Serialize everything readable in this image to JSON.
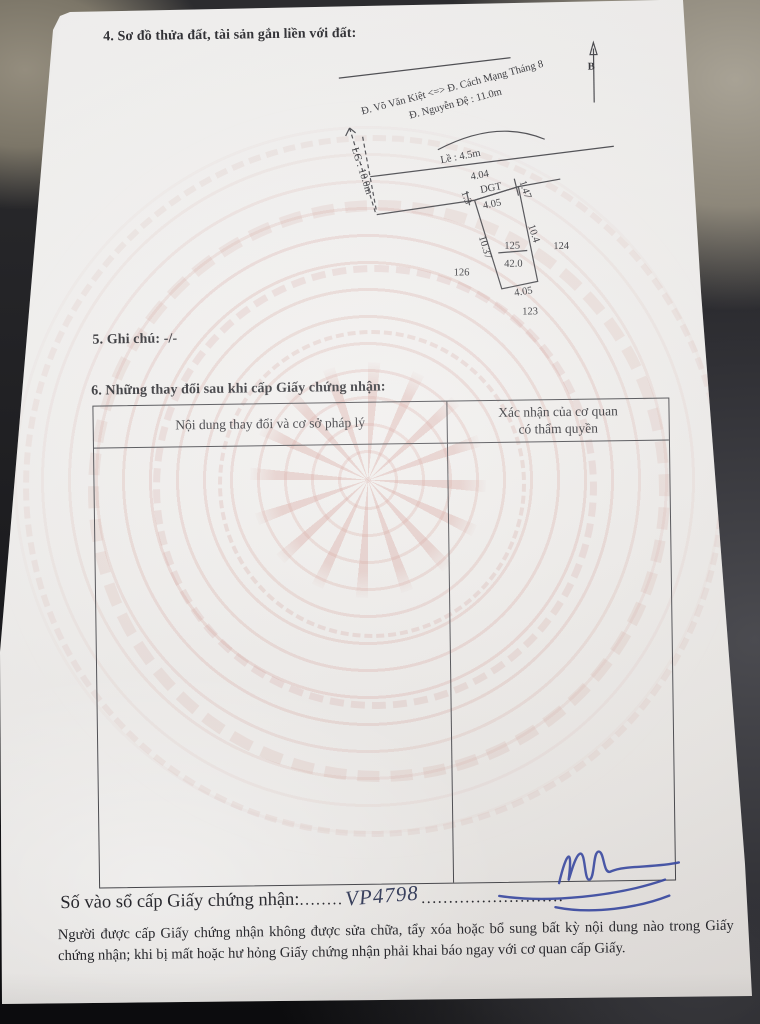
{
  "colors": {
    "paper": "#f0eeec",
    "pattern_pink": "#dfb6af",
    "ink": "#222228",
    "signature_blue": "#2e3f9e",
    "background_dark": "#1d1d20"
  },
  "document": {
    "section4_title": "4. Sơ đồ thửa đất, tài sản gắn liền với đất:",
    "diagram": {
      "north_label": "B",
      "street_line1": "Đ. Võ Văn Kiệt <=> Đ. Cách Mạng Tháng 8",
      "street_line2": "Đ. Nguyễn Đệ : 11.0m",
      "road_widening_label": "LG : 10.0m",
      "sidewalk_label": "Lề : 4.5m",
      "frontage_length": "4.04",
      "road_strip_label": "DGT",
      "strip_right_length": "1.47",
      "strip_left_length": "1.3",
      "parcel_top_length": "4.05",
      "parcel_left_length": "10.37",
      "parcel_right_length": "10.4",
      "parcel_number": "125",
      "parcel_area": "42.0",
      "parcel_bottom_length": "4.05",
      "neighbor_parcel_bottom": "123",
      "neighbor_parcel_right": "124",
      "neighbor_parcel_left": "126"
    },
    "section5_note": "5. Ghi chú: -/-",
    "section6_title": "6. Những thay đổi sau khi cấp Giấy chứng nhận:",
    "table": {
      "col1_header": "Nội dung thay đổi và cơ sở pháp lý",
      "col2_header_line1": "Xác nhận của cơ quan",
      "col2_header_line2": "có thẩm quyền"
    },
    "registry": {
      "label": "Số vào sổ cấp Giấy chứng nhận:",
      "dots_before": "........",
      "number": "VP4798",
      "dots_after": ".........................."
    },
    "footer_notice": "Người được cấp Giấy chứng nhận không được sửa chữa, tẩy xóa hoặc bổ sung bất kỳ nội dung nào trong Giấy chứng nhận; khi bị mất hoặc hư hỏng Giấy chứng nhận phải khai báo ngay với cơ quan cấp Giấy."
  }
}
